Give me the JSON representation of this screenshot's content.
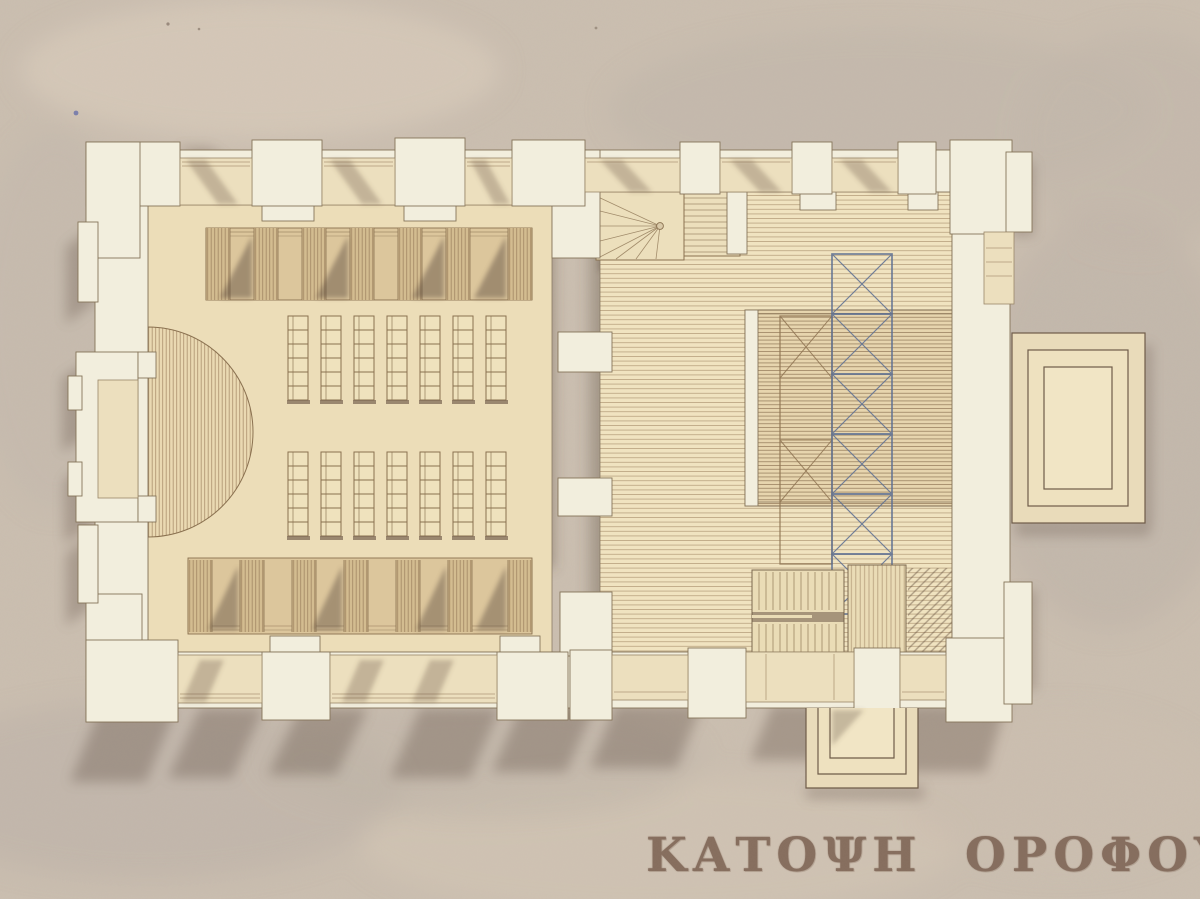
{
  "drawing": {
    "title": "ΚΑΤΟΨΗ ΟΡΟΦΟΥ"
  },
  "palette": {
    "paper": "#cbbfb1",
    "paper_shade": "#bdb2a9",
    "wall_fill": "#f2eedd",
    "floor_left_hall": "#ecddb8",
    "floor_right_hall": "#f0e3c0",
    "bench_fill": "#d9c398",
    "bay_fill": "#ecdfbe",
    "porch_fill": "#e9dbba",
    "ink_line": "#7b684f",
    "hatch_line": "#8f7452",
    "shadow": "#5f4e42",
    "truss_blue": "#5d6f93",
    "title_ink": "#7c6353"
  }
}
